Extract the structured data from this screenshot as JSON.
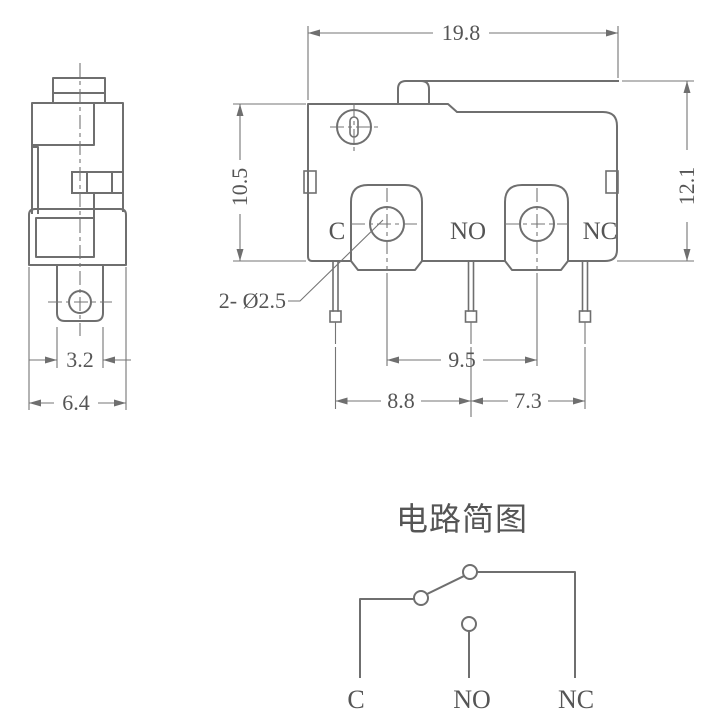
{
  "front_view": {
    "dims": {
      "width": "19.8",
      "overall_height": "12.1",
      "body_height": "10.5",
      "terminal_hole_spacing": "9.5",
      "pin_pitch_left": "8.8",
      "pin_pitch_right": "7.3"
    },
    "hole_callout": "2- Ø2.5",
    "terminals": {
      "common": "C",
      "normally_open": "NO",
      "normally_closed": "NC"
    }
  },
  "side_view": {
    "dims": {
      "terminal_width": "3.2",
      "body_width": "6.4"
    }
  },
  "circuit_diagram": {
    "title": "电路简图",
    "terminals": {
      "common": "C",
      "normally_open": "NO",
      "normally_closed": "NC"
    }
  },
  "colors": {
    "line": "#6f6f6f",
    "text": "#555555",
    "background": "#ffffff"
  }
}
